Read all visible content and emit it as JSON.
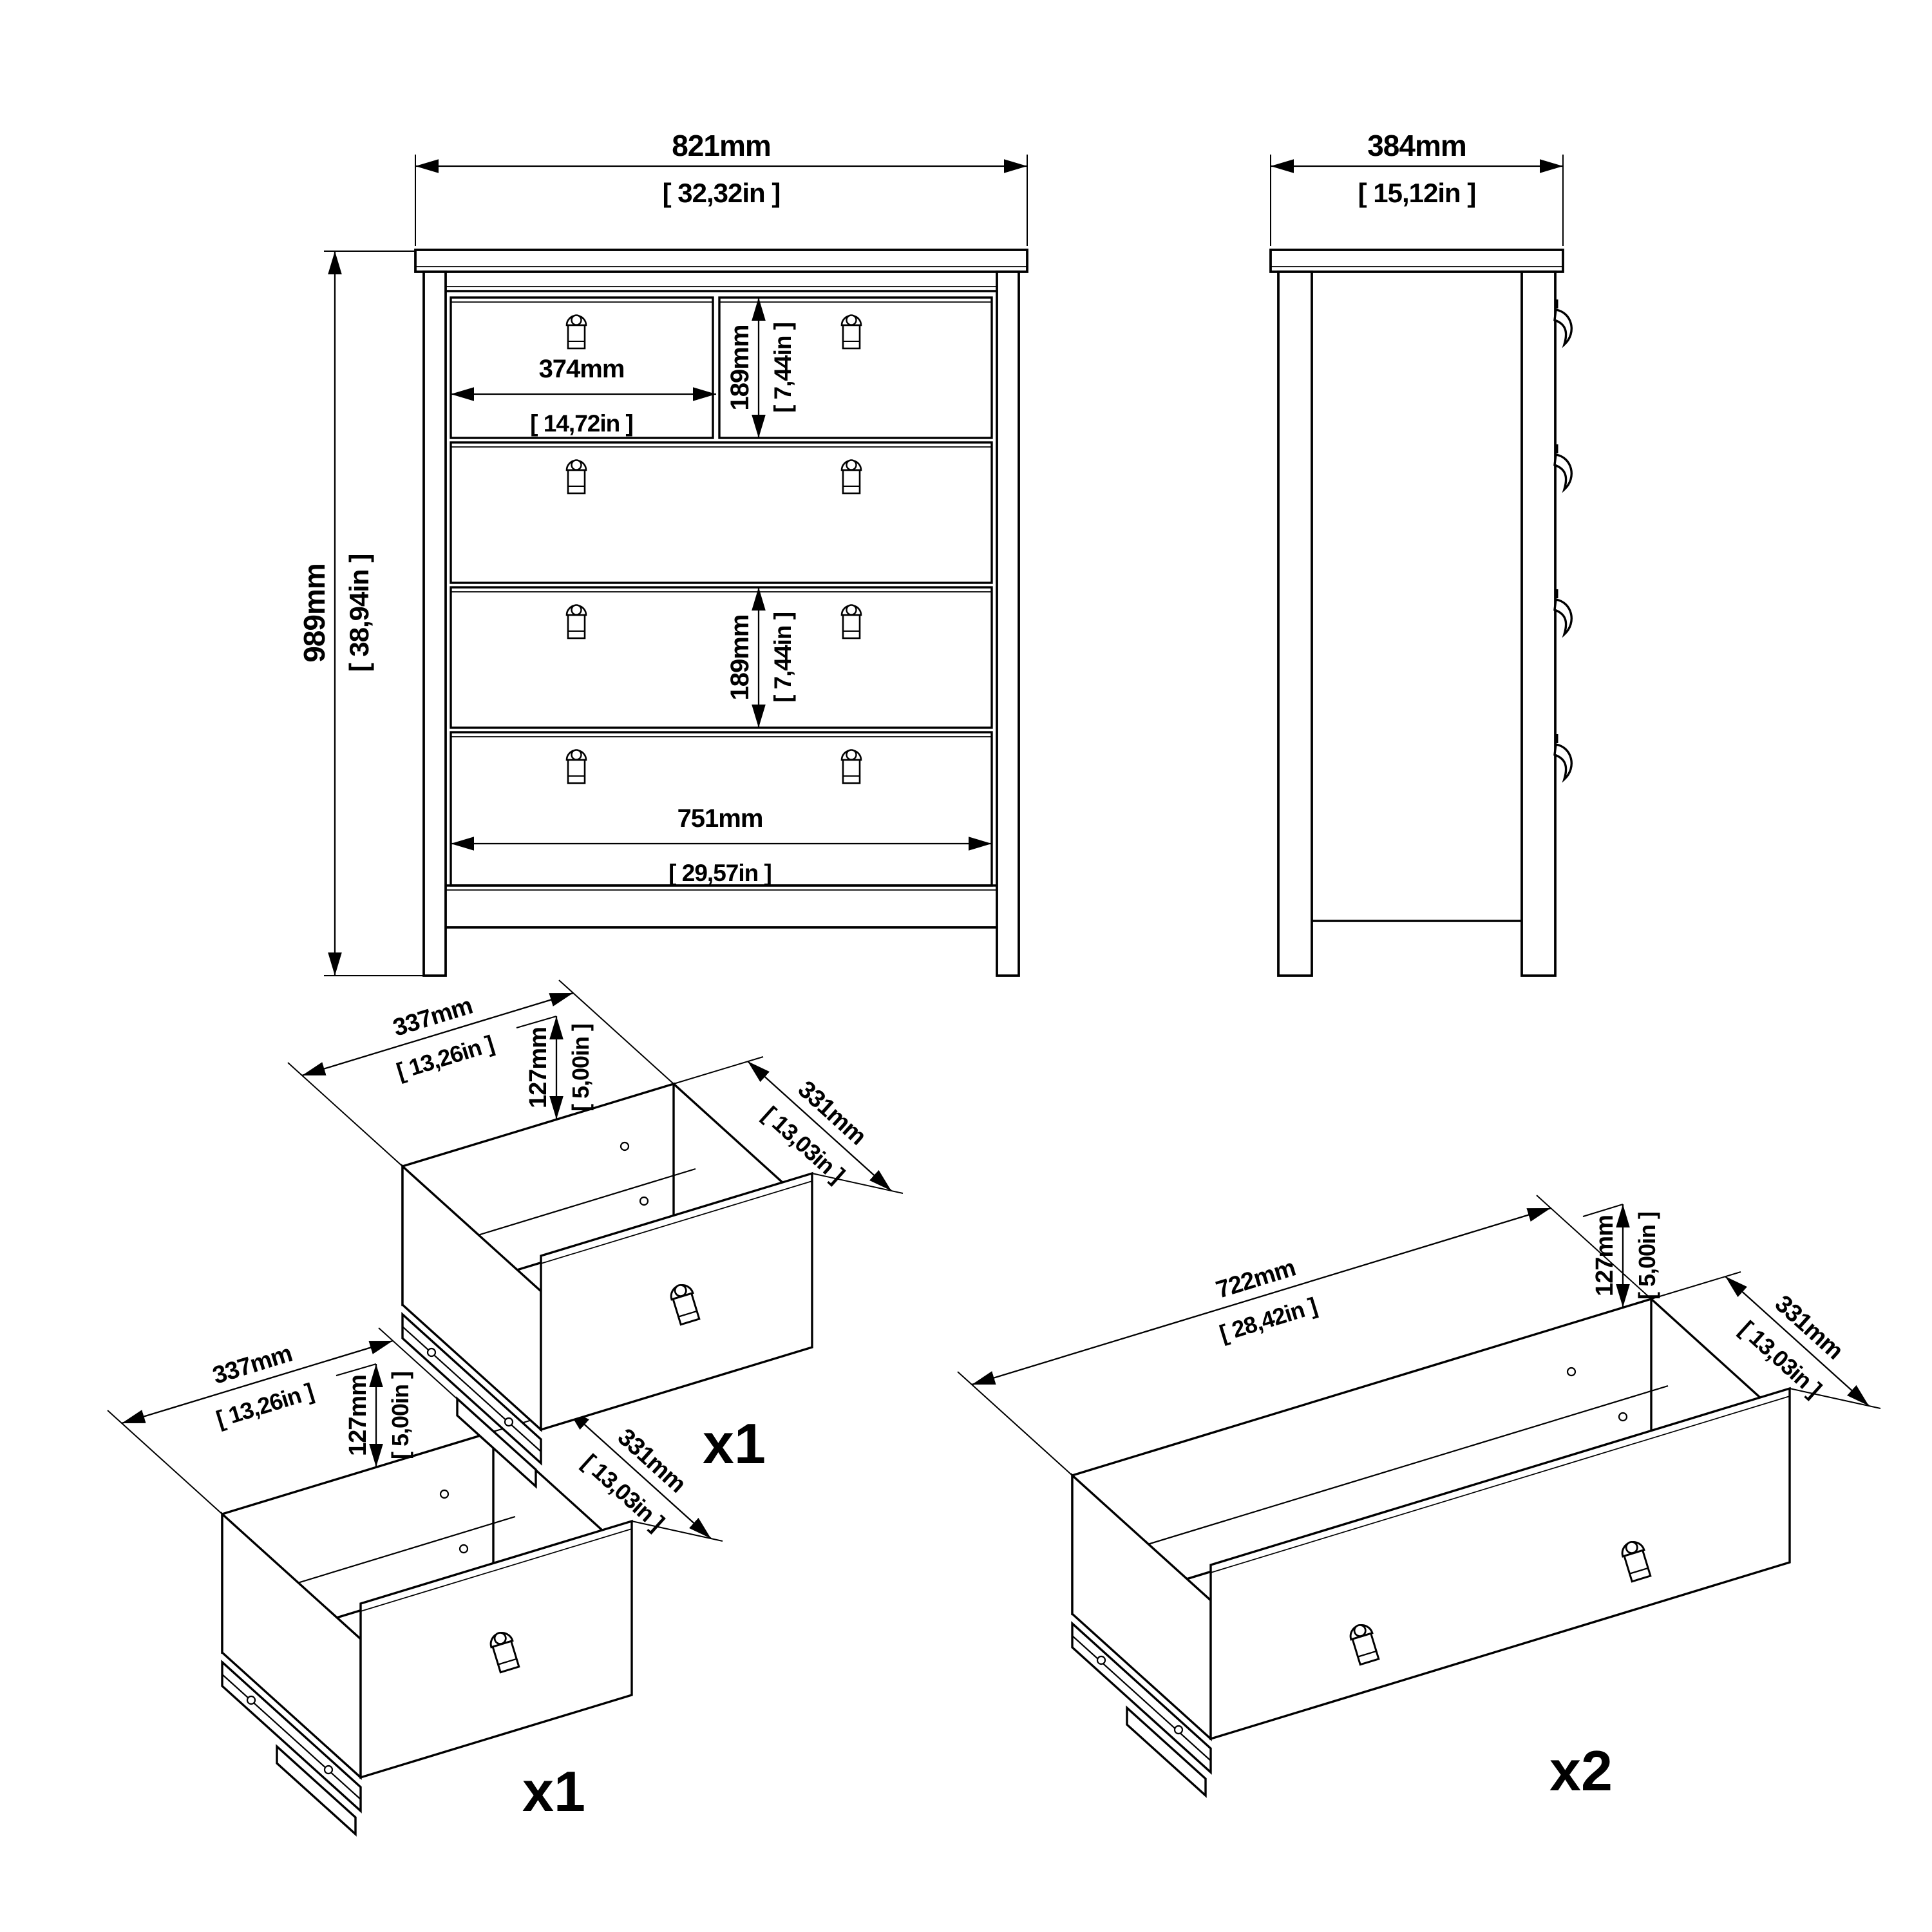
{
  "drawing": {
    "front_view": {
      "overall_width_mm": "821mm",
      "overall_width_in": "[ 32,32in ]",
      "overall_height_mm": "989mm",
      "overall_height_in": "[ 38,94in ]",
      "top_drawer_width_mm": "374mm",
      "top_drawer_width_in": "[ 14,72in ]",
      "top_drawer_height_mm": "189mm",
      "top_drawer_height_in": "[ 7,44in ]",
      "mid_drawer_height_mm": "189mm",
      "mid_drawer_height_in": "[ 7,44in ]",
      "inner_width_mm": "751mm",
      "inner_width_in": "[ 29,57in ]"
    },
    "side_view": {
      "overall_depth_mm": "384mm",
      "overall_depth_in": "[ 15,12in ]"
    },
    "drawer_small_a": {
      "width_mm": "337mm",
      "width_in": "[ 13,26in ]",
      "height_mm": "127mm",
      "height_in": "[ 5,00in ]",
      "depth_mm": "331mm",
      "depth_in": "[ 13,03in ]",
      "quantity": "x1"
    },
    "drawer_small_b": {
      "width_mm": "337mm",
      "width_in": "[ 13,26in ]",
      "height_mm": "127mm",
      "height_in": "[ 5,00in ]",
      "depth_mm": "331mm",
      "depth_in": "[ 13,03in ]",
      "quantity": "x1"
    },
    "drawer_wide": {
      "width_mm": "722mm",
      "width_in": "[ 28,42in ]",
      "height_mm": "127mm",
      "height_in": "[ 5,00in ]",
      "depth_mm": "331mm",
      "depth_in": "[ 13,03in ]",
      "quantity": "x2"
    },
    "colors": {
      "line": "#000000",
      "background": "#ffffff"
    }
  }
}
